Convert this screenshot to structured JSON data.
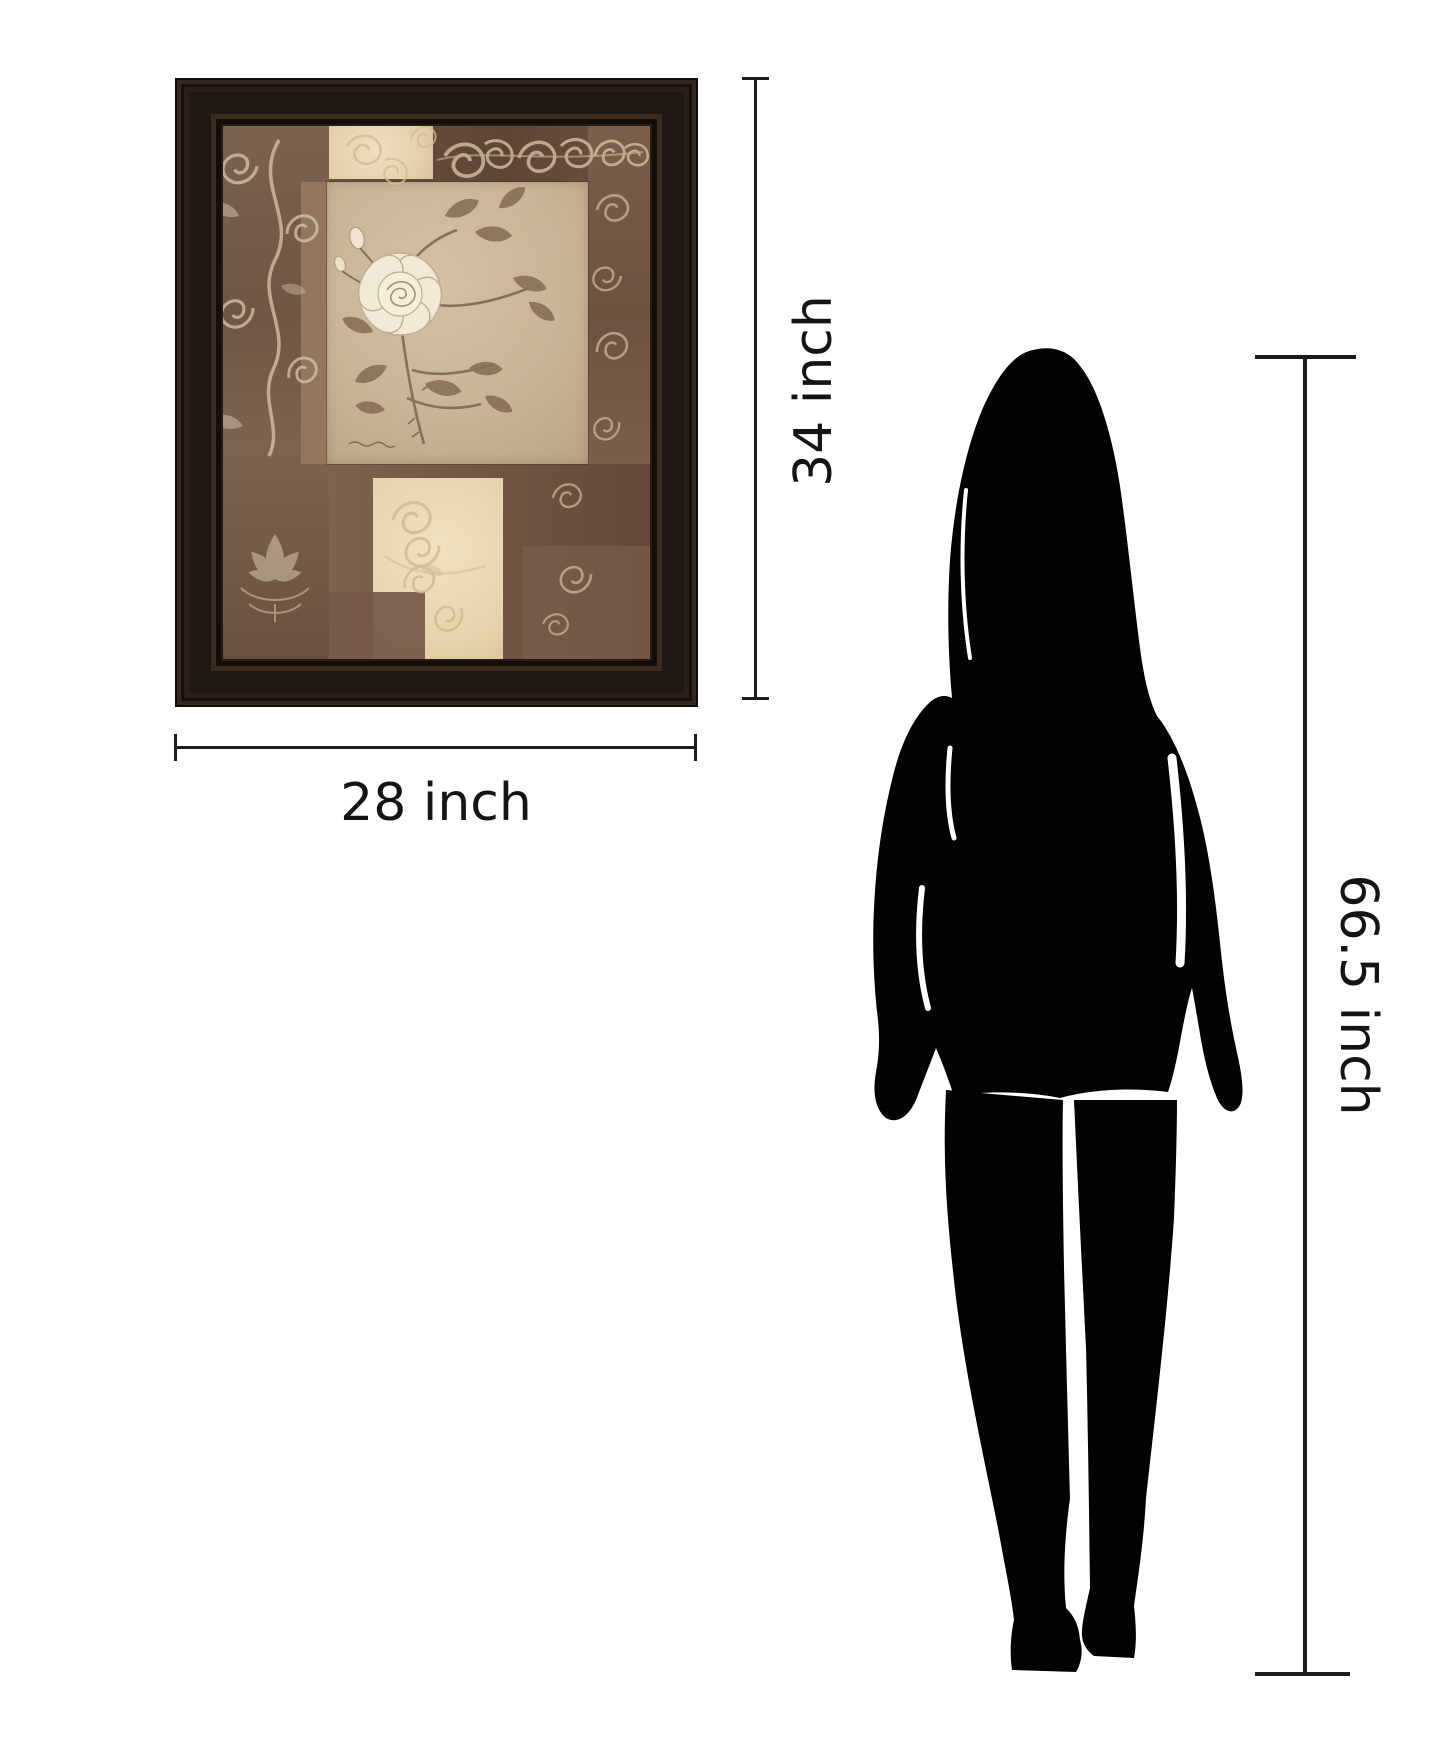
{
  "canvas": {
    "background": "#ffffff"
  },
  "product": {
    "kind": "framed wall art, vintage rose collage print",
    "frame_color": "#241a14",
    "art_palette": {
      "brown": "#7c6350",
      "dark_brown": "#66503f",
      "tan_panel": "#c9b69a",
      "cream": "#e9dab8",
      "ornament": "#d6c6ab",
      "leaf": "#8a7258",
      "rose": "#f3ecdb"
    }
  },
  "dimensions": {
    "frame_height": {
      "label": "34 inch"
    },
    "frame_width": {
      "label": "28 inch"
    },
    "figure_height": {
      "label": "66.5 inch"
    }
  },
  "reference_figure": {
    "type": "woman silhouette",
    "color": "#000000"
  },
  "annotation": {
    "line_color": "#1c1c1c",
    "text_color": "#141414"
  }
}
